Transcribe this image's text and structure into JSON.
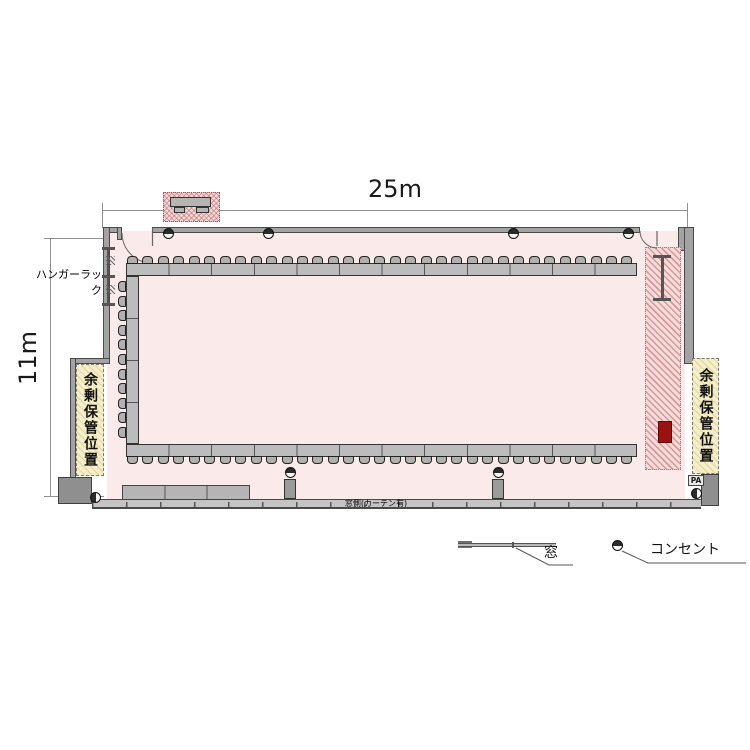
{
  "diagram": {
    "dimension_width": "25m",
    "dimension_height": "11m",
    "hanger_rack_label": "ハンガーラック",
    "storage_left_label": "余剰保管位置",
    "storage_right_label": "余剰保管位置",
    "window_side_label": "窓側(カーテン有)",
    "pa_label": "PA"
  },
  "legend": {
    "window_label": "窓",
    "outlet_label": "コンセント"
  },
  "colors": {
    "floor": "#fbeaea",
    "wall": "#a3a3a3",
    "wall_edge": "#4a4a4a",
    "table": "#bcbcbc",
    "chair": "#b0b0b0",
    "storage_hatch": "#f6eec9",
    "red_zone": "#f3dcdc",
    "red_accent": "#9b1212"
  },
  "furniture": {
    "top_row_tables": 12,
    "bottom_row_tables": 12,
    "left_column_tables": 4,
    "counter_segments": 3,
    "top_chairs": 33,
    "bottom_chairs": 33,
    "left_chairs": 11
  },
  "outlets": {
    "wall_top_x": [
      168,
      268,
      513,
      628
    ],
    "floor_pedestal_x": [
      290,
      498
    ]
  }
}
